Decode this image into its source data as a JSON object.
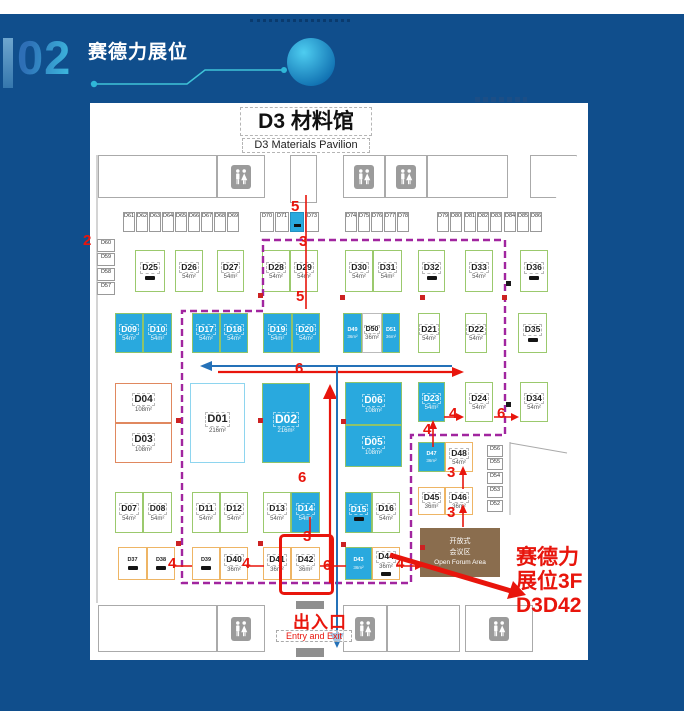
{
  "header": {
    "number": "02",
    "title": "赛德力展位"
  },
  "colors": {
    "background": "#104e8c",
    "booth_blue": "#29a9de",
    "route_purple": "#a1259f",
    "highlight_red": "#e8150c",
    "arrow_blue": "#2471b8",
    "forum_brown": "#8a6d4e",
    "accent_cyan": "#3cb4dc"
  },
  "map": {
    "title": "D3 材料馆",
    "subtitle": "D3 Materials Pavilion",
    "entry_cn": "出入口",
    "entry_en": "Entry and Exit",
    "forum": [
      "开放式",
      "会议区",
      "Open Forum Area"
    ],
    "annotation": [
      "赛德力",
      "展位3F",
      "D3D42"
    ],
    "booths": [
      {
        "id": "D25",
        "x": 45,
        "y": 147,
        "w": 30,
        "h": 42,
        "t": "green",
        "lg": 1
      },
      {
        "id": "D26",
        "x": 85,
        "y": 147,
        "w": 28,
        "h": 42,
        "t": "green",
        "a": "54m²"
      },
      {
        "id": "D27",
        "x": 127,
        "y": 147,
        "w": 27,
        "h": 42,
        "t": "green",
        "a": "54m²"
      },
      {
        "id": "D28",
        "x": 172,
        "y": 147,
        "w": 28,
        "h": 42,
        "t": "green",
        "a": "54m²"
      },
      {
        "id": "D29",
        "x": 200,
        "y": 147,
        "w": 28,
        "h": 42,
        "t": "green",
        "a": "54m²"
      },
      {
        "id": "D30",
        "x": 255,
        "y": 147,
        "w": 28,
        "h": 42,
        "t": "green",
        "a": "54m²"
      },
      {
        "id": "D31",
        "x": 283,
        "y": 147,
        "w": 29,
        "h": 42,
        "t": "green",
        "a": "54m²"
      },
      {
        "id": "D32",
        "x": 328,
        "y": 147,
        "w": 27,
        "h": 42,
        "t": "green",
        "lg": 1
      },
      {
        "id": "D33",
        "x": 375,
        "y": 147,
        "w": 28,
        "h": 42,
        "t": "green",
        "a": "54m²"
      },
      {
        "id": "D36",
        "x": 430,
        "y": 147,
        "w": 28,
        "h": 42,
        "t": "green",
        "lg": 1
      },
      {
        "id": "D09",
        "x": 25,
        "y": 210,
        "w": 28,
        "h": 40,
        "t": "blue",
        "a": "54m²"
      },
      {
        "id": "D10",
        "x": 53,
        "y": 210,
        "w": 29,
        "h": 40,
        "t": "blue",
        "a": "54m²"
      },
      {
        "id": "D17",
        "x": 102,
        "y": 210,
        "w": 28,
        "h": 40,
        "t": "blue",
        "a": "54m²"
      },
      {
        "id": "D18",
        "x": 130,
        "y": 210,
        "w": 28,
        "h": 40,
        "t": "blue",
        "a": "54m²"
      },
      {
        "id": "D19",
        "x": 173,
        "y": 210,
        "w": 29,
        "h": 40,
        "t": "blue",
        "a": "54m²"
      },
      {
        "id": "D20",
        "x": 202,
        "y": 210,
        "w": 28,
        "h": 40,
        "t": "blue",
        "a": "54m²"
      },
      {
        "id": "D49",
        "x": 253,
        "y": 210,
        "w": 19,
        "h": 40,
        "t": "blue",
        "a": "36m²",
        "tiny": 1
      },
      {
        "id": "D50",
        "x": 272,
        "y": 210,
        "w": 20,
        "h": 40,
        "t": "wh",
        "a": "36m²",
        "fs": 7
      },
      {
        "id": "D51",
        "x": 292,
        "y": 210,
        "w": 18,
        "h": 40,
        "t": "blue",
        "a": "36m²",
        "tiny": 1
      },
      {
        "id": "D21",
        "x": 328,
        "y": 210,
        "w": 22,
        "h": 40,
        "t": "green",
        "a": "54m²"
      },
      {
        "id": "D22",
        "x": 375,
        "y": 210,
        "w": 22,
        "h": 40,
        "t": "green",
        "a": "54m²"
      },
      {
        "id": "D35",
        "x": 428,
        "y": 210,
        "w": 29,
        "h": 40,
        "t": "green",
        "lg": 1
      },
      {
        "id": "D04",
        "x": 25,
        "y": 280,
        "w": 57,
        "h": 40,
        "t": "orange",
        "a": "108m²",
        "fs": 10
      },
      {
        "id": "D03",
        "x": 25,
        "y": 320,
        "w": 57,
        "h": 40,
        "t": "orange",
        "a": "108m²",
        "fs": 10
      },
      {
        "id": "D01",
        "x": 100,
        "y": 280,
        "w": 55,
        "h": 80,
        "t": "lb",
        "a": "216m²",
        "fs": 11
      },
      {
        "id": "D02",
        "x": 172,
        "y": 280,
        "w": 48,
        "h": 80,
        "t": "blue",
        "a": "216m²",
        "fs": 12
      },
      {
        "id": "D06",
        "x": 255,
        "y": 279,
        "w": 57,
        "h": 43,
        "t": "blue",
        "a": "108m²",
        "fs": 10
      },
      {
        "id": "D05",
        "x": 255,
        "y": 322,
        "w": 57,
        "h": 42,
        "t": "blue",
        "a": "108m²",
        "fs": 10
      },
      {
        "id": "D23",
        "x": 328,
        "y": 279,
        "w": 27,
        "h": 40,
        "t": "blue",
        "a": "54m²"
      },
      {
        "id": "D24",
        "x": 375,
        "y": 279,
        "w": 28,
        "h": 40,
        "t": "green",
        "a": "54m²"
      },
      {
        "id": "D34",
        "x": 430,
        "y": 279,
        "w": 28,
        "h": 40,
        "t": "green",
        "a": "54m²"
      },
      {
        "id": "D47",
        "x": 328,
        "y": 339,
        "w": 27,
        "h": 30,
        "t": "blue",
        "a": "36m²",
        "tiny": 1
      },
      {
        "id": "D48",
        "x": 355,
        "y": 339,
        "w": 28,
        "h": 30,
        "t": "amber",
        "a": "54m²"
      },
      {
        "id": "D45",
        "x": 328,
        "y": 384,
        "w": 27,
        "h": 28,
        "t": "amber",
        "a": "36m²"
      },
      {
        "id": "D46",
        "x": 355,
        "y": 384,
        "w": 28,
        "h": 28,
        "t": "amber",
        "a": "36m²"
      },
      {
        "id": "D07",
        "x": 25,
        "y": 389,
        "w": 28,
        "h": 41,
        "t": "green",
        "a": "54m²"
      },
      {
        "id": "D08",
        "x": 53,
        "y": 389,
        "w": 29,
        "h": 41,
        "t": "green",
        "a": "54m²"
      },
      {
        "id": "D11",
        "x": 102,
        "y": 389,
        "w": 28,
        "h": 41,
        "t": "green",
        "a": "54m²"
      },
      {
        "id": "D12",
        "x": 130,
        "y": 389,
        "w": 28,
        "h": 41,
        "t": "green",
        "a": "54m²"
      },
      {
        "id": "D13",
        "x": 173,
        "y": 389,
        "w": 28,
        "h": 41,
        "t": "green",
        "a": "54m²"
      },
      {
        "id": "D14",
        "x": 201,
        "y": 389,
        "w": 29,
        "h": 41,
        "t": "blue",
        "a": "54m²"
      },
      {
        "id": "D15",
        "x": 255,
        "y": 389,
        "w": 27,
        "h": 41,
        "t": "blue",
        "lg": 1
      },
      {
        "id": "D16",
        "x": 282,
        "y": 389,
        "w": 28,
        "h": 41,
        "t": "green",
        "a": "54m²"
      },
      {
        "id": "D37",
        "x": 28,
        "y": 444,
        "w": 29,
        "h": 33,
        "t": "amber",
        "lg": 1,
        "tiny": 1
      },
      {
        "id": "D38",
        "x": 57,
        "y": 444,
        "w": 28,
        "h": 33,
        "t": "amber",
        "lg": 1,
        "tiny": 1
      },
      {
        "id": "D39",
        "x": 102,
        "y": 444,
        "w": 28,
        "h": 33,
        "t": "amber",
        "lg": 1,
        "tiny": 1
      },
      {
        "id": "D40",
        "x": 130,
        "y": 444,
        "w": 28,
        "h": 33,
        "t": "amber",
        "a": "36m²"
      },
      {
        "id": "D41",
        "x": 173,
        "y": 444,
        "w": 28,
        "h": 33,
        "t": "amber",
        "a": "36m²"
      },
      {
        "id": "D42",
        "x": 201,
        "y": 444,
        "w": 29,
        "h": 33,
        "t": "amber",
        "a": "36m²"
      },
      {
        "id": "D43",
        "x": 255,
        "y": 444,
        "w": 27,
        "h": 33,
        "t": "blue",
        "a": "36m²",
        "tiny": 1
      },
      {
        "id": "D44",
        "x": 282,
        "y": 444,
        "w": 28,
        "h": 33,
        "t": "amber",
        "a": "36m²",
        "lg": 1
      }
    ],
    "small_booths": [
      {
        "id": "D61",
        "x": 33,
        "y": 109,
        "w": 12,
        "h": 20
      },
      {
        "id": "D62",
        "x": 46,
        "y": 109,
        "w": 12,
        "h": 20
      },
      {
        "id": "D63",
        "x": 59,
        "y": 109,
        "w": 12,
        "h": 20
      },
      {
        "id": "D64",
        "x": 72,
        "y": 109,
        "w": 12,
        "h": 20
      },
      {
        "id": "D65",
        "x": 85,
        "y": 109,
        "w": 12,
        "h": 20
      },
      {
        "id": "D66",
        "x": 98,
        "y": 109,
        "w": 12,
        "h": 20
      },
      {
        "id": "D67",
        "x": 111,
        "y": 109,
        "w": 12,
        "h": 20
      },
      {
        "id": "D68",
        "x": 124,
        "y": 109,
        "w": 12,
        "h": 20
      },
      {
        "id": "D69",
        "x": 137,
        "y": 109,
        "w": 12,
        "h": 20
      },
      {
        "id": "D70",
        "x": 170,
        "y": 109,
        "w": 14,
        "h": 20
      },
      {
        "id": "D71",
        "x": 185,
        "y": 109,
        "w": 14,
        "h": 20
      },
      {
        "id": "",
        "x": 200,
        "y": 109,
        "w": 14,
        "h": 20,
        "blue": 1
      },
      {
        "id": "D73",
        "x": 215,
        "y": 109,
        "w": 14,
        "h": 20
      },
      {
        "id": "D74",
        "x": 255,
        "y": 109,
        "w": 12,
        "h": 20
      },
      {
        "id": "D75",
        "x": 268,
        "y": 109,
        "w": 12,
        "h": 20
      },
      {
        "id": "D76",
        "x": 281,
        "y": 109,
        "w": 12,
        "h": 20
      },
      {
        "id": "D77",
        "x": 294,
        "y": 109,
        "w": 12,
        "h": 20
      },
      {
        "id": "D78",
        "x": 307,
        "y": 109,
        "w": 12,
        "h": 20
      },
      {
        "id": "D79",
        "x": 347,
        "y": 109,
        "w": 12,
        "h": 20
      },
      {
        "id": "D80",
        "x": 360,
        "y": 109,
        "w": 12,
        "h": 20
      },
      {
        "id": "D81",
        "x": 374,
        "y": 109,
        "w": 12,
        "h": 20
      },
      {
        "id": "D82",
        "x": 387,
        "y": 109,
        "w": 12,
        "h": 20
      },
      {
        "id": "D83",
        "x": 400,
        "y": 109,
        "w": 12,
        "h": 20
      },
      {
        "id": "D84",
        "x": 414,
        "y": 109,
        "w": 12,
        "h": 20
      },
      {
        "id": "D85",
        "x": 427,
        "y": 109,
        "w": 12,
        "h": 20
      },
      {
        "id": "D86",
        "x": 440,
        "y": 109,
        "w": 12,
        "h": 20
      },
      {
        "id": "D60",
        "x": 7,
        "y": 136,
        "w": 18,
        "h": 13
      },
      {
        "id": "D59",
        "x": 7,
        "y": 150,
        "w": 18,
        "h": 13
      },
      {
        "id": "D58",
        "x": 7,
        "y": 165,
        "w": 18,
        "h": 13
      },
      {
        "id": "D57",
        "x": 7,
        "y": 179,
        "w": 18,
        "h": 13
      },
      {
        "id": "D56",
        "x": 397,
        "y": 342,
        "w": 16,
        "h": 12
      },
      {
        "id": "D55",
        "x": 397,
        "y": 355,
        "w": 16,
        "h": 12
      },
      {
        "id": "D54",
        "x": 397,
        "y": 369,
        "w": 16,
        "h": 12
      },
      {
        "id": "D53",
        "x": 397,
        "y": 383,
        "w": 16,
        "h": 12
      },
      {
        "id": "D52",
        "x": 397,
        "y": 397,
        "w": 16,
        "h": 12
      }
    ],
    "structures": [
      {
        "x": 8,
        "y": 52,
        "w": 119,
        "h": 43
      },
      {
        "x": 127,
        "y": 52,
        "w": 48,
        "h": 43,
        "wc": 1
      },
      {
        "x": 200,
        "y": 52,
        "w": 27,
        "h": 48
      },
      {
        "x": 253,
        "y": 52,
        "w": 42,
        "h": 43,
        "wc": 1
      },
      {
        "x": 295,
        "y": 52,
        "w": 42,
        "h": 43,
        "wc": 1
      },
      {
        "x": 337,
        "y": 52,
        "w": 81,
        "h": 43
      },
      {
        "x": 440,
        "y": 52,
        "w": 47,
        "h": 43,
        "trap": 1
      },
      {
        "x": 8,
        "y": 502,
        "w": 119,
        "h": 47
      },
      {
        "x": 127,
        "y": 502,
        "w": 48,
        "h": 47,
        "wc": 1
      },
      {
        "x": 253,
        "y": 502,
        "w": 44,
        "h": 47,
        "wc": 1
      },
      {
        "x": 297,
        "y": 502,
        "w": 73,
        "h": 47
      },
      {
        "x": 375,
        "y": 502,
        "w": 68,
        "h": 47,
        "wc": 1
      }
    ],
    "route_numbers": [
      {
        "t": "2",
        "x": -7,
        "y": 130
      },
      {
        "t": "5",
        "x": 201,
        "y": 96
      },
      {
        "t": "3",
        "x": 209,
        "y": 131
      },
      {
        "t": "5",
        "x": 206,
        "y": 186
      },
      {
        "t": "6",
        "x": 205,
        "y": 258
      },
      {
        "t": "6",
        "x": 208,
        "y": 367
      },
      {
        "t": "3",
        "x": 213,
        "y": 426
      },
      {
        "t": "4",
        "x": 359,
        "y": 303
      },
      {
        "t": "6",
        "x": 407,
        "y": 303
      },
      {
        "t": "4",
        "x": 333,
        "y": 319
      },
      {
        "t": "3",
        "x": 357,
        "y": 362
      },
      {
        "t": "3",
        "x": 357,
        "y": 402
      },
      {
        "t": "4",
        "x": 78,
        "y": 453
      },
      {
        "t": "4",
        "x": 152,
        "y": 453
      },
      {
        "t": "6",
        "x": 233,
        "y": 455
      },
      {
        "t": "4",
        "x": 306,
        "y": 453
      }
    ],
    "markers": [
      {
        "x": 86,
        "y": 315
      },
      {
        "x": 168,
        "y": 315
      },
      {
        "x": 251,
        "y": 316
      },
      {
        "x": 86,
        "y": 438
      },
      {
        "x": 168,
        "y": 438
      },
      {
        "x": 251,
        "y": 439
      },
      {
        "x": 168,
        "y": 190
      },
      {
        "x": 250,
        "y": 192
      },
      {
        "x": 330,
        "y": 192
      },
      {
        "x": 412,
        "y": 192
      },
      {
        "x": 330,
        "y": 442
      },
      {
        "x": 416,
        "y": 178,
        "k": 1
      },
      {
        "x": 416,
        "y": 299,
        "k": 1
      }
    ]
  }
}
